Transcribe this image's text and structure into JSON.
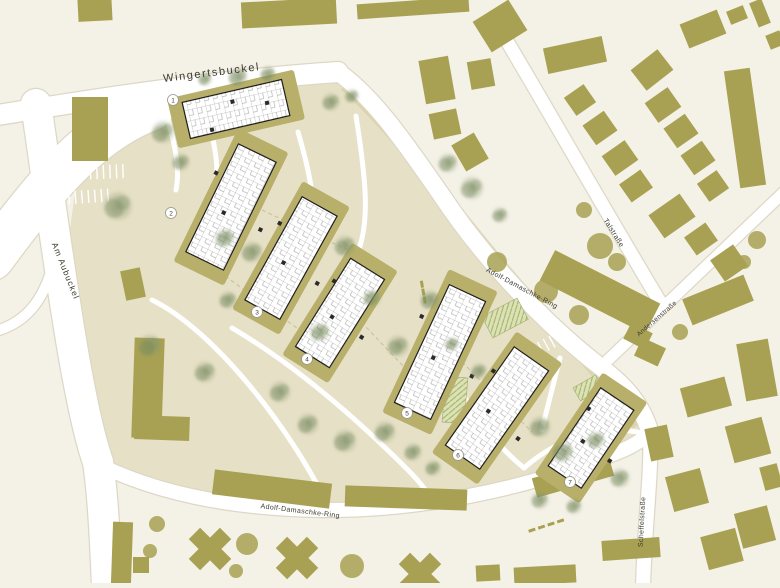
{
  "plan_title": "site plan",
  "palette": {
    "background": "#f4f1e6",
    "site_ground": "#e6e0c6",
    "edge_band": "#d6cf9f",
    "street": "#ffffff",
    "street_edge": "#ddd8c6",
    "existing_building": "#a8a153",
    "pad": "#b8af6a",
    "new_building_fill": "#ffffff",
    "new_building_line": "#1e1e1e",
    "core_dark": "#2a2a2a",
    "tree_green_core": "#72855a",
    "tree_green_mid": "#86976d",
    "tree_olive": "#a8a153",
    "label_color": "#3c3b31",
    "hatch_fill": "#dce2b2",
    "hatch_line": "#9fae72",
    "dash_line": "#c6bf9e"
  },
  "street_labels": [
    {
      "id": "wingertsbuckel",
      "text": "Wingertsbuckel",
      "x": 212,
      "y": 76,
      "rotation": -7,
      "size": 11,
      "spacing": 1.6
    },
    {
      "id": "am-aubuckel",
      "text": "Am Aubuckel",
      "x": 63,
      "y": 272,
      "rotation": 68,
      "size": 8.5,
      "spacing": 1
    },
    {
      "id": "adolf-damaschke-ring-upper",
      "text": "Adolf-Damaschke-Ring",
      "x": 521,
      "y": 290,
      "rotation": 28,
      "size": 7,
      "spacing": 0.4
    },
    {
      "id": "talstrasse",
      "text": "Talstraße",
      "x": 612,
      "y": 234,
      "rotation": 58,
      "size": 7,
      "spacing": 0.4
    },
    {
      "id": "andersenstrasse",
      "text": "Andersenstraße",
      "x": 658,
      "y": 320,
      "rotation": -41,
      "size": 6.5,
      "spacing": 0.3
    },
    {
      "id": "adolf-damaschke-ring-lower",
      "text": "Adolf-Damaschke-Ring",
      "x": 300,
      "y": 513,
      "rotation": 7,
      "size": 7,
      "spacing": 0.4
    },
    {
      "id": "scheffelstrasse",
      "text": "Scheffelstraße",
      "x": 644,
      "y": 522,
      "rotation": -87,
      "size": 7,
      "spacing": 0.4
    }
  ],
  "new_buildings": [
    {
      "number": "1",
      "cx": 236,
      "cy": 109,
      "length": 102,
      "width": 37,
      "angle": -13,
      "badge_x": 173,
      "badge_y": 100
    },
    {
      "number": "2",
      "cx": 231,
      "cy": 207,
      "length": 120,
      "width": 42,
      "angle": 116,
      "badge_x": 171,
      "badge_y": 213
    },
    {
      "number": "3",
      "cx": 291,
      "cy": 258,
      "length": 118,
      "width": 40,
      "angle": 119,
      "badge_x": 257,
      "badge_y": 312
    },
    {
      "number": "4",
      "cx": 340,
      "cy": 313,
      "length": 104,
      "width": 40,
      "angle": 122,
      "badge_x": 307,
      "badge_y": 359
    },
    {
      "number": "5",
      "cx": 440,
      "cy": 352,
      "length": 130,
      "width": 40,
      "angle": 115,
      "badge_x": 407,
      "badge_y": 413
    },
    {
      "number": "6",
      "cx": 497,
      "cy": 408,
      "length": 120,
      "width": 42,
      "angle": 125,
      "badge_x": 458,
      "badge_y": 455
    },
    {
      "number": "7",
      "cx": 591,
      "cy": 438,
      "length": 94,
      "width": 40,
      "angle": 124,
      "badge_x": 570,
      "badge_y": 482
    }
  ],
  "site_outline": "M 78 168 L 96 122 L 150 108 L 240 90 L 335 78 L 370 108 L 420 170 L 468 238 L 520 300 L 575 355 L 618 392 L 638 425 L 640 442 L 600 458 L 540 472 L 470 492 L 380 504 L 290 510 L 205 504 L 130 487 L 98 468 L 88 400 L 74 300 L 70 230 Z",
  "edge_band": "M 345 85 C 395 130 450 205 505 270 C 555 330 600 370 638 425",
  "streets": [
    {
      "id": "interchange",
      "d": "M -8 258 C 48 182 92 130 152 108",
      "w": 44
    },
    {
      "id": "am-aubuckel",
      "d": "M 36 104 C 56 240 76 400 98 462 C 103 495 105 540 107 586",
      "w": 30
    },
    {
      "id": "slip-road",
      "d": "M -8 332 C 26 324 44 300 54 262",
      "w": 10
    },
    {
      "id": "wingertsbuckel",
      "d": "M -8 116 C 100 98 220 80 338 72",
      "w": 20
    },
    {
      "id": "adolf-damaschke-ring-upper",
      "d": "M 338 72 C 372 96 402 138 442 196 C 482 256 542 322 602 368 C 628 388 642 406 650 432",
      "w": 17
    },
    {
      "id": "talstrasse",
      "d": "M 498 26 C 540 96 600 202 660 302",
      "w": 13
    },
    {
      "id": "andersenstrasse",
      "d": "M 608 360 L 784 192",
      "w": 11
    },
    {
      "id": "adolf-damaschke-ring-lower",
      "d": "M 90 460 C 150 492 230 509 322 510 C 422 511 522 488 592 462 C 614 454 638 446 650 432",
      "w": 14
    },
    {
      "id": "scheffelstrasse",
      "d": "M 650 432 C 652 470 645 520 643 586",
      "w": 14
    }
  ],
  "inner_paths": [
    "M 204 96 C 212 140 222 160 214 205",
    "M 298 132 C 312 180 318 210 306 242",
    "M 356 116 C 366 180 370 220 358 252",
    "M 232 328 C 290 362 350 412 408 470 C 420 482 428 492 434 504",
    "M 152 300 C 214 330 292 430 328 506",
    "M 430 326 C 452 380 478 430 524 468",
    "M 560 358 C 552 390 546 412 542 430",
    "M 524 468 C 560 436 606 424 648 434",
    "M 168 120 C 176 150 180 170 176 190"
  ],
  "dashed_lines": [
    "M 214 268 L 330 352",
    "M 342 302 L 428 392",
    "M 452 352 L 532 432",
    "M 262 210 L 352 252"
  ],
  "existing_buildings": [
    [
      95,
      10,
      34,
      22,
      -3
    ],
    [
      289,
      13,
      95,
      26,
      -3
    ],
    [
      413,
      8,
      112,
      15,
      -4
    ],
    [
      500,
      26,
      42,
      36,
      -32
    ],
    [
      90,
      129,
      36,
      64,
      0
    ],
    [
      703,
      29,
      40,
      26,
      -22
    ],
    [
      737,
      15,
      18,
      14,
      -22
    ],
    [
      760,
      13,
      13,
      26,
      -22
    ],
    [
      775,
      40,
      15,
      15,
      -22
    ],
    [
      437,
      80,
      30,
      44,
      -10
    ],
    [
      481,
      74,
      24,
      28,
      -10
    ],
    [
      445,
      124,
      28,
      26,
      -12
    ],
    [
      470,
      152,
      26,
      30,
      -30
    ],
    [
      575,
      55,
      60,
      26,
      -12
    ],
    [
      652,
      70,
      34,
      26,
      -38
    ],
    [
      580,
      100,
      24,
      22,
      -35
    ],
    [
      600,
      128,
      26,
      24,
      -35
    ],
    [
      620,
      158,
      28,
      24,
      -35
    ],
    [
      636,
      186,
      26,
      22,
      -35
    ],
    [
      745,
      128,
      26,
      118,
      -8
    ],
    [
      663,
      105,
      28,
      24,
      -35
    ],
    [
      681,
      131,
      26,
      24,
      -35
    ],
    [
      698,
      158,
      26,
      24,
      -35
    ],
    [
      713,
      186,
      24,
      22,
      -35
    ],
    [
      672,
      216,
      38,
      28,
      -35
    ],
    [
      701,
      239,
      26,
      22,
      -35
    ],
    [
      729,
      263,
      28,
      26,
      -35
    ],
    [
      718,
      300,
      66,
      28,
      -22
    ],
    [
      757,
      370,
      32,
      58,
      -10
    ],
    [
      650,
      352,
      26,
      20,
      25
    ],
    [
      600,
      292,
      118,
      34,
      27
    ],
    [
      638,
      336,
      24,
      18,
      27
    ],
    [
      706,
      397,
      46,
      30,
      -15
    ],
    [
      748,
      440,
      38,
      38,
      -15
    ],
    [
      659,
      443,
      23,
      33,
      -12
    ],
    [
      687,
      490,
      36,
      36,
      -15
    ],
    [
      755,
      527,
      34,
      36,
      -15
    ],
    [
      722,
      549,
      36,
      34,
      -15
    ],
    [
      771,
      477,
      18,
      24,
      -15
    ],
    [
      631,
      549,
      58,
      20,
      -4
    ],
    [
      545,
      575,
      62,
      18,
      -3
    ],
    [
      488,
      573,
      24,
      16,
      -3
    ],
    [
      122,
      553,
      20,
      62,
      2
    ],
    [
      141,
      565,
      16,
      16,
      0
    ],
    [
      133,
      284,
      20,
      30,
      -12
    ],
    [
      148,
      388,
      30,
      100,
      2
    ],
    [
      162,
      428,
      55,
      24,
      2
    ],
    [
      272,
      489,
      118,
      25,
      7
    ],
    [
      406,
      498,
      122,
      21,
      2
    ],
    [
      573,
      477,
      80,
      20,
      -16
    ]
  ],
  "cross_buildings": [
    [
      210,
      549,
      44
    ],
    [
      297,
      558,
      44
    ],
    [
      420,
      574,
      44
    ]
  ],
  "trees_green": [
    [
      118,
      206,
      16
    ],
    [
      163,
      132,
      13
    ],
    [
      205,
      79,
      8
    ],
    [
      238,
      77,
      11
    ],
    [
      268,
      74,
      9
    ],
    [
      331,
      102,
      10
    ],
    [
      352,
      96,
      8
    ],
    [
      181,
      162,
      10
    ],
    [
      225,
      238,
      11
    ],
    [
      252,
      252,
      12
    ],
    [
      228,
      300,
      10
    ],
    [
      150,
      346,
      13
    ],
    [
      205,
      372,
      12
    ],
    [
      280,
      392,
      12
    ],
    [
      320,
      332,
      11
    ],
    [
      345,
      246,
      12
    ],
    [
      372,
      298,
      10
    ],
    [
      398,
      346,
      12
    ],
    [
      430,
      300,
      11
    ],
    [
      308,
      424,
      12
    ],
    [
      345,
      441,
      13
    ],
    [
      385,
      432,
      12
    ],
    [
      413,
      452,
      10
    ],
    [
      433,
      468,
      9
    ],
    [
      448,
      163,
      11
    ],
    [
      472,
      188,
      13
    ],
    [
      500,
      215,
      9
    ],
    [
      540,
      427,
      12
    ],
    [
      563,
      452,
      12
    ],
    [
      596,
      440,
      10
    ],
    [
      620,
      478,
      11
    ],
    [
      540,
      500,
      10
    ],
    [
      574,
      506,
      9
    ],
    [
      452,
      344,
      8
    ],
    [
      479,
      371,
      9
    ]
  ],
  "trees_olive": [
    [
      497,
      262,
      10
    ],
    [
      546,
      291,
      12
    ],
    [
      579,
      315,
      10
    ],
    [
      600,
      246,
      13
    ],
    [
      617,
      262,
      9
    ],
    [
      584,
      210,
      8
    ],
    [
      157,
      524,
      8
    ],
    [
      150,
      551,
      7
    ],
    [
      236,
      571,
      7
    ],
    [
      247,
      544,
      11
    ],
    [
      352,
      566,
      12
    ],
    [
      680,
      332,
      8
    ],
    [
      757,
      240,
      9
    ],
    [
      744,
      262,
      7
    ]
  ],
  "playgrounds": [
    [
      505,
      318,
      40,
      24,
      -28
    ],
    [
      455,
      400,
      22,
      46,
      5
    ],
    [
      588,
      388,
      26,
      15,
      -30
    ]
  ],
  "parking_rows": [
    {
      "cx": 100,
      "cy": 165,
      "angle": -2,
      "count": 9,
      "len": 14,
      "gap": 6.5
    },
    {
      "cx": 88,
      "cy": 190,
      "angle": -4,
      "count": 8,
      "len": 13,
      "gap": 6.5
    },
    {
      "cx": 549,
      "cy": 336,
      "angle": -28,
      "count": 6,
      "len": 13,
      "gap": 6.5
    },
    {
      "cx": 500,
      "cy": 388,
      "angle": 22,
      "count": 6,
      "len": 12,
      "gap": 6.5
    }
  ],
  "olive_dashes": [
    {
      "cx": 551,
      "cy": 524,
      "angle": -18,
      "count": 4,
      "gap": 10
    },
    {
      "cx": 424,
      "cy": 296,
      "angle": 80,
      "count": 3,
      "gap": 8
    }
  ]
}
